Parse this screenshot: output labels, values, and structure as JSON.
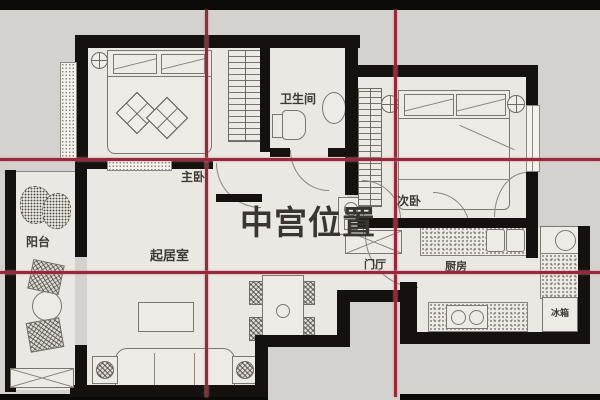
{
  "overlay": {
    "center_text": "中宫位置",
    "center_text_color": "#3a3531",
    "grid_color": "#97293a",
    "grid_vertical_x": [
      207,
      396
    ],
    "grid_horizontal_y": [
      159,
      272
    ]
  },
  "rooms": {
    "master_bedroom": {
      "label": "主卧"
    },
    "bathroom": {
      "label": "卫生间"
    },
    "second_bedroom": {
      "label": "次卧"
    },
    "balcony": {
      "label": "阳台"
    },
    "living_room": {
      "label": "起居室"
    },
    "entry_hall": {
      "label": "门厅"
    },
    "kitchen": {
      "label": "厨房"
    },
    "fridge": {
      "label": "冰箱"
    }
  },
  "colors": {
    "background": "#d3d2cf",
    "floor": "#eae8e2",
    "wall": "#14110e",
    "top_bottom_bars": "#0b0a09",
    "furniture_line": "#7b766f"
  }
}
